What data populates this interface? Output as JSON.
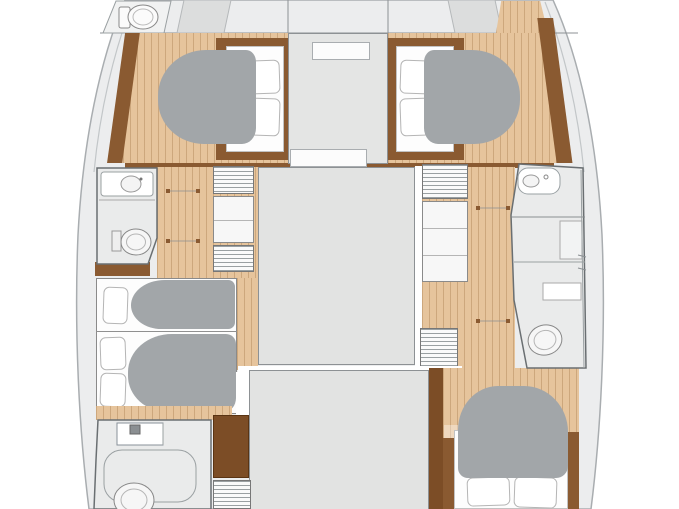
{
  "diagram": {
    "type": "yacht-floor-plan",
    "vessel": "catamaran",
    "view": "lower-deck cabin layout, bow at top",
    "stats": {
      "sleeping_cabins": 4,
      "berths": 5,
      "heads": 4,
      "companionway_steps": 2
    }
  },
  "palette": {
    "wood": "#e6c49c",
    "brown": "#8a5a31",
    "wardrobe_brown": "#7c4d26",
    "duvet_gray": "#a2a6a9",
    "deck_gray": "#ecedee",
    "module_gray": "#e2e3e2",
    "bath_gray": "#eaebeb",
    "outline_gray": "#8d9194",
    "wall_gray": "#6a6f72",
    "white": "#ffffff"
  },
  "rooms": {
    "port_bow_head": {
      "label": "Port bow head",
      "fixtures": [
        "toilet"
      ]
    },
    "port_forward_cabin": {
      "label": "Port forward cabin",
      "furniture": [
        "double berth",
        "2 pillows",
        "duvet",
        "wood sole"
      ]
    },
    "port_mid_head": {
      "label": "Port mid head",
      "fixtures": [
        "vanity counter",
        "sink",
        "toilet"
      ]
    },
    "port_aft_berths": {
      "label": "Port aft cabin",
      "furniture": [
        "2 berths",
        "3 pillows",
        "2 duvets"
      ]
    },
    "port_aft_head": {
      "label": "Port aft head",
      "fixtures": [
        "sink unit",
        "shower",
        "toilet"
      ]
    },
    "starboard_forward_cabin": {
      "label": "Starboard forward cabin",
      "furniture": [
        "double berth",
        "2 pillows",
        "duvet",
        "wood sole"
      ]
    },
    "starboard_head": {
      "label": "Starboard head",
      "fixtures": [
        "sink",
        "cabinet",
        "counter",
        "toilet"
      ]
    },
    "starboard_aft_cabin": {
      "label": "Starboard aft cabin",
      "furniture": [
        "double berth",
        "2 pillows",
        "duvet",
        "wood sole"
      ]
    },
    "center_modules": {
      "foredeck_strip": "Foredeck / trampoline strip",
      "bridgedeck_forward": "Forward bridgedeck module",
      "saloon_cutout": "Saloon cutout (mid)",
      "aft_cutout": "Aft cockpit cutout",
      "entry_hatch": "Saloon entry step"
    },
    "circulation": {
      "port_corridor": "Port hull corridor",
      "starboard_corridor": "Starboard hull corridor",
      "port_steps": "Port companionway steps",
      "starboard_steps": "Starboard companionway steps",
      "lockers": "Hull storage lockers",
      "port_wardrobe": "Port aft wardrobe"
    }
  }
}
